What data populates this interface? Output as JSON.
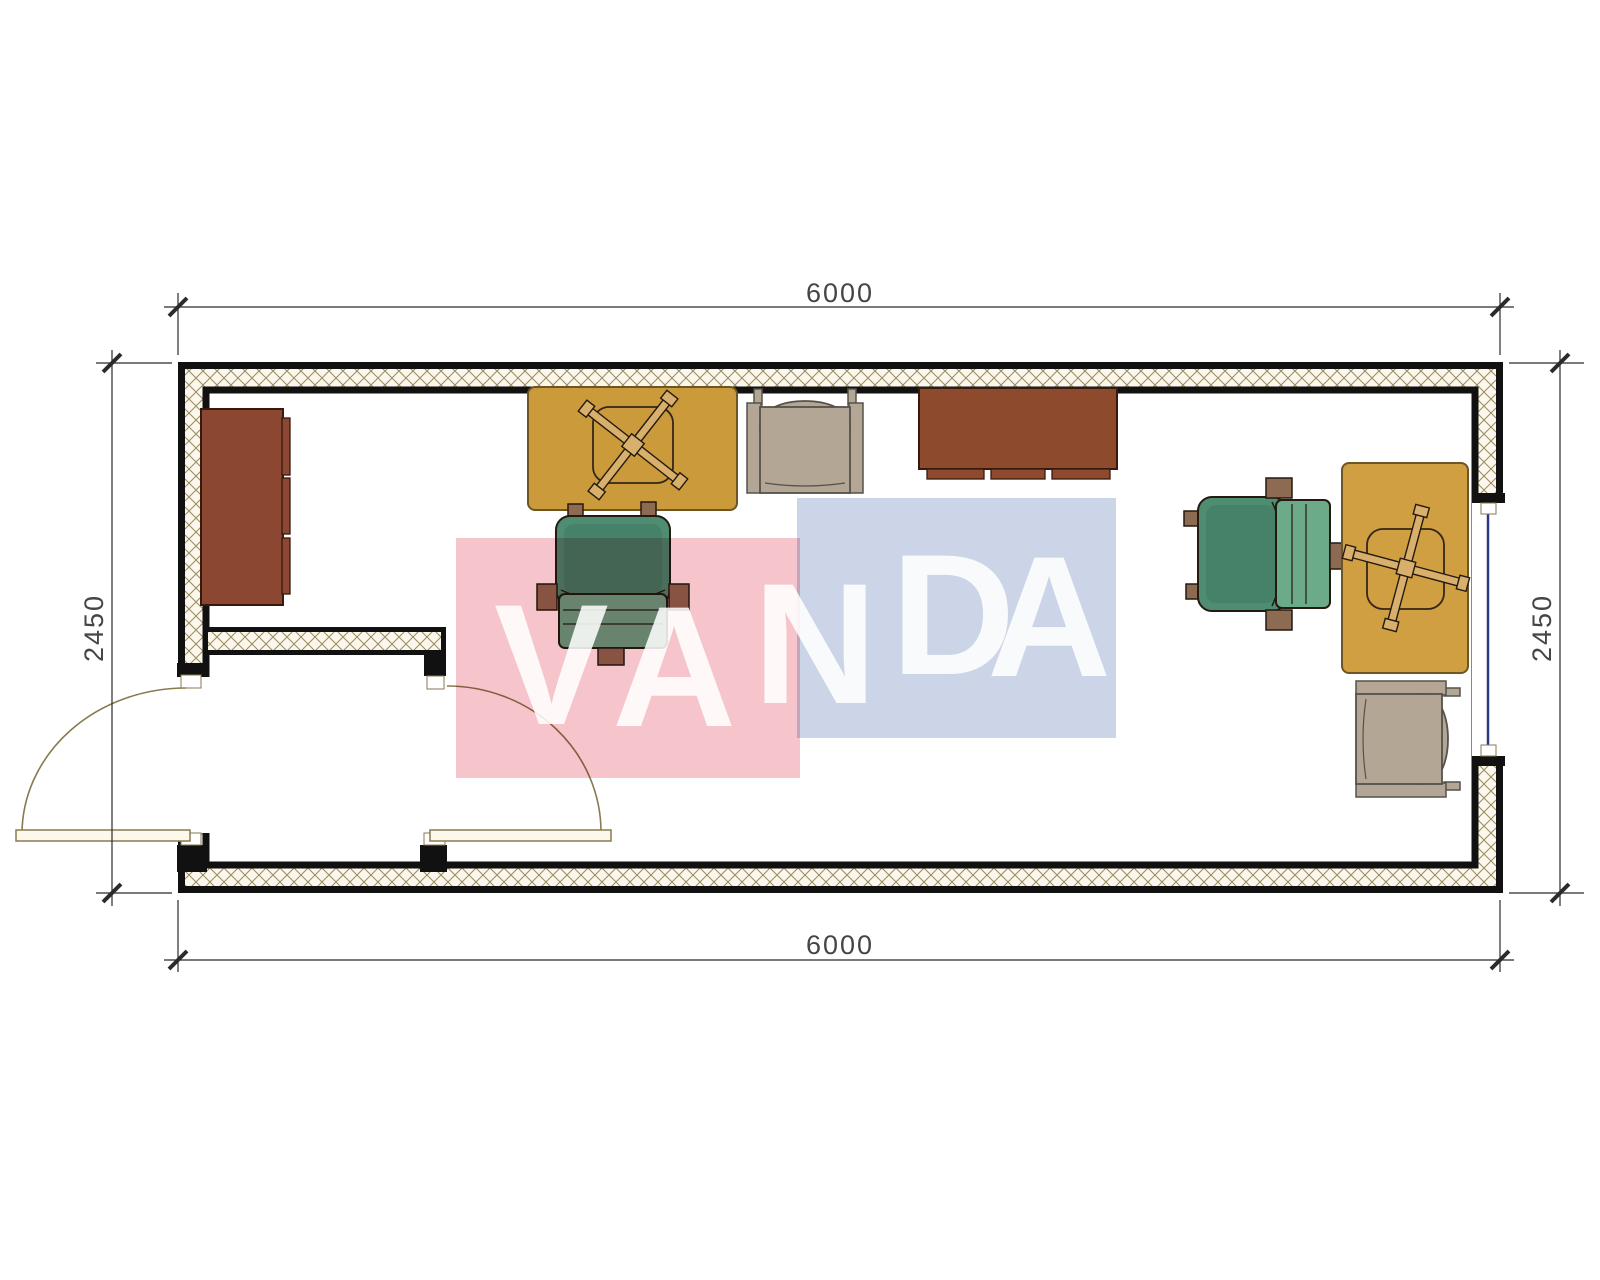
{
  "dimensions": {
    "top": "6000",
    "bottom": "6000",
    "left": "2450",
    "right": "2450"
  },
  "watermark": {
    "text": "VANDA",
    "letters": [
      "V",
      "A",
      "N",
      "D",
      "A"
    ],
    "pink_color": "#f6c5cc",
    "blue_color": "#cbd5e7",
    "letter_color": "#ffffff"
  },
  "plan": {
    "colors": {
      "wall_line": "#111111",
      "hatch_line": "#988a5e",
      "hatch_bg": "#fbf7ec",
      "floor": "#ffffff",
      "door": "#8a7a50",
      "door_leaf_fill": "#fdf8ec",
      "window_glass": "#2b3a85",
      "jamb_fill": "#ffffff",
      "desk": "#cb9a3a",
      "desk2": "#cf9f41",
      "desk_outline": "#6d5624",
      "cabinet": "#8b4731",
      "sideboard": "#8e4a2c",
      "wood_dark_outline": "#38190e",
      "chair_back": "#4e8d71",
      "chair_seat": "#6cab8a",
      "chair_trim": "#8d6b52",
      "chair_outline": "#241a10",
      "armchair": "#b3a695",
      "armchair_outline": "#55524a",
      "xbase_fill": "#d8b06c",
      "dim_line": "#2b2b2b"
    },
    "furniture_items": [
      "wall-cabinet-left",
      "desk-left",
      "task-chair-left",
      "armchair-top",
      "sideboard-top",
      "task-chair-right",
      "desk-right",
      "armchair-bottom-right"
    ]
  }
}
